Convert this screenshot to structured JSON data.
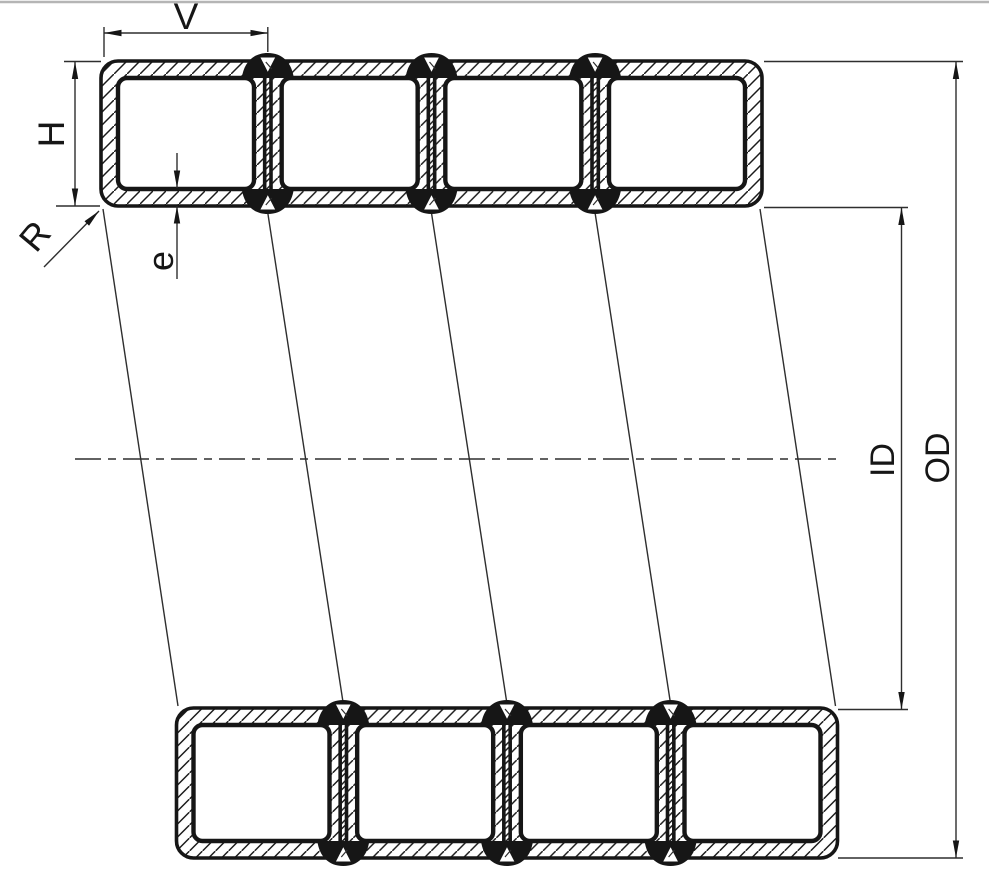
{
  "diagram": {
    "labels": {
      "cell_width": "V",
      "cell_height": "H",
      "corner_radius": "R",
      "wall_thickness": "e",
      "inner_diameter": "ID",
      "outer_diameter": "OD"
    },
    "colors": {
      "background": "#ffffff",
      "line": "#161616",
      "thin_line": "#2e2e2e",
      "top_border": "#b5b5b5"
    }
  }
}
